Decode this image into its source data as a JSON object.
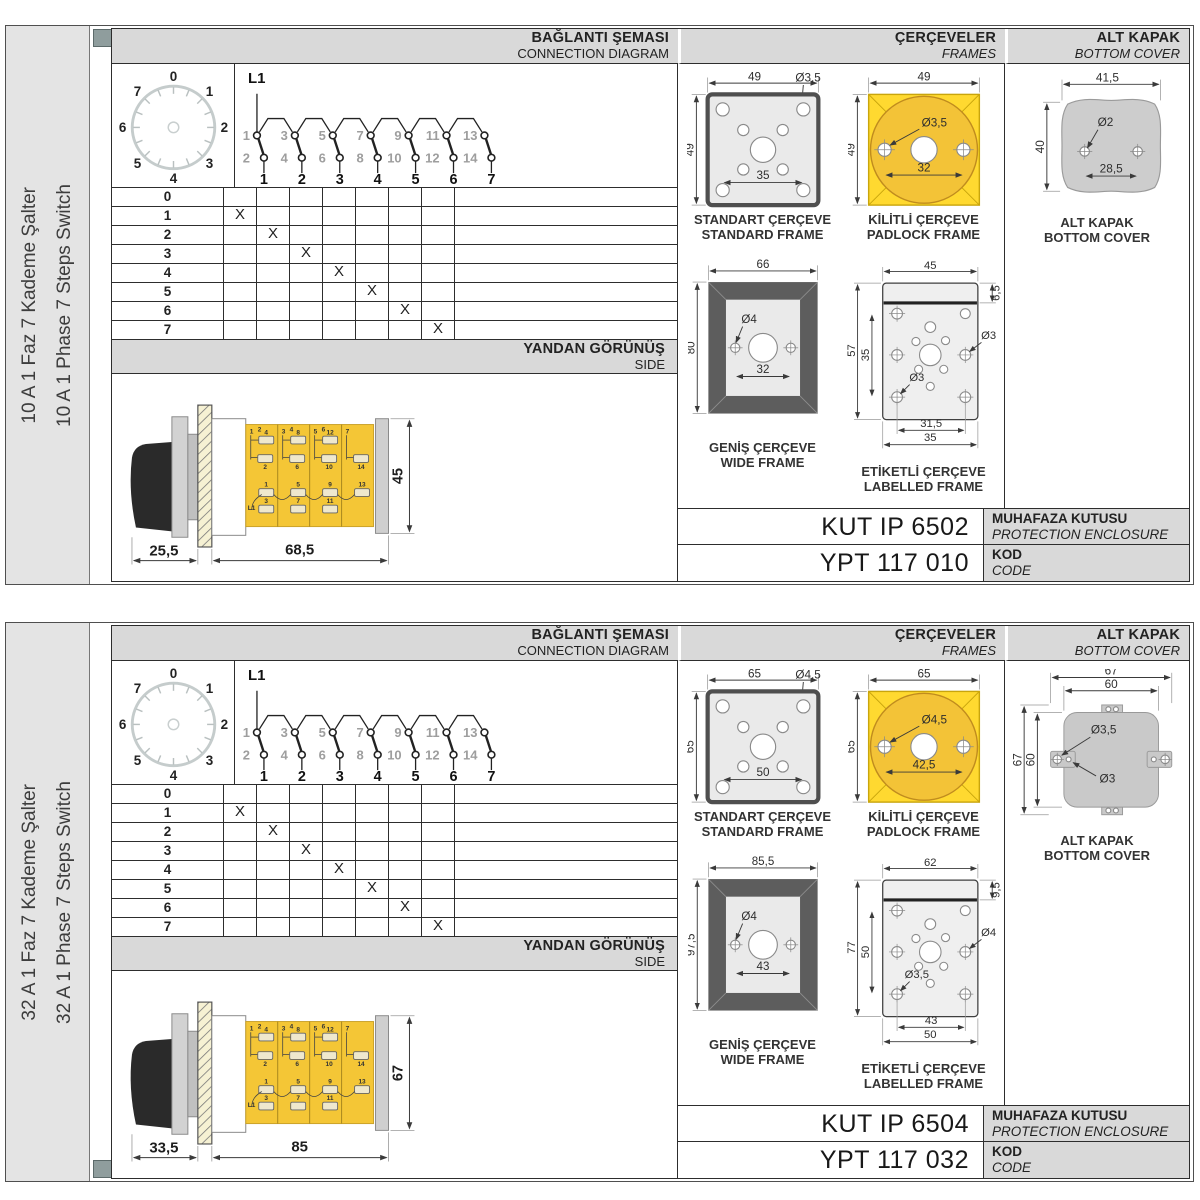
{
  "colors": {
    "header_bg": "#d9d9d9",
    "panel_border": "#4f4f4f",
    "sidebar_bg": "#e4e4e4",
    "marker": "#8f9d9d",
    "line_dark": "#2d2d2d",
    "yellow": "#ffd930",
    "yellow_deep": "#f3c337",
    "gray_fill": "#eaeaea",
    "bezel": "#5d5d5d",
    "cover_gray": "#cbcbcb"
  },
  "panels": [
    {
      "sidebar": {
        "title_tr": "10 A 1 Faz 7 Kademe Şalter",
        "title_en": "10 A 1 Phase 7 Steps Switch",
        "marker_top": true,
        "marker_bottom": null
      },
      "headers": {
        "connection_tr": "BAĞLANTI ŞEMASI",
        "connection_en": "CONNECTION DIAGRAM",
        "frames_tr": "ÇERÇEVELER",
        "frames_en": "FRAMES",
        "cover_tr": "ALT KAPAK",
        "cover_en": "BOTTOM COVER",
        "side_tr": "YANDAN GÖRÜNÜŞ",
        "side_en": "SIDE"
      },
      "dial": {
        "positions": [
          "0",
          "1",
          "2",
          "3",
          "4",
          "5",
          "6",
          "7"
        ]
      },
      "circuit": {
        "line_label": "L1",
        "switches": [
          {
            "top": "1",
            "bottom": "2",
            "column": "1"
          },
          {
            "top": "3",
            "bottom": "4",
            "column": "2"
          },
          {
            "top": "5",
            "bottom": "6",
            "column": "3"
          },
          {
            "top": "7",
            "bottom": "8",
            "column": "4"
          },
          {
            "top": "9",
            "bottom": "10",
            "column": "5"
          },
          {
            "top": "11",
            "bottom": "12",
            "column": "6"
          },
          {
            "top": "13",
            "bottom": "14",
            "column": "7"
          }
        ]
      },
      "step_table": {
        "rows": [
          {
            "label": "0",
            "marks": [
              "",
              "",
              "",
              "",
              "",
              "",
              ""
            ]
          },
          {
            "label": "1",
            "marks": [
              "X",
              "",
              "",
              "",
              "",
              "",
              ""
            ]
          },
          {
            "label": "2",
            "marks": [
              "",
              "X",
              "",
              "",
              "",
              "",
              ""
            ]
          },
          {
            "label": "3",
            "marks": [
              "",
              "",
              "X",
              "",
              "",
              "",
              ""
            ]
          },
          {
            "label": "4",
            "marks": [
              "",
              "",
              "",
              "X",
              "",
              "",
              ""
            ]
          },
          {
            "label": "5",
            "marks": [
              "",
              "",
              "",
              "",
              "X",
              "",
              ""
            ]
          },
          {
            "label": "6",
            "marks": [
              "",
              "",
              "",
              "",
              "",
              "X",
              ""
            ]
          },
          {
            "label": "7",
            "marks": [
              "",
              "",
              "",
              "",
              "",
              "",
              "X"
            ]
          }
        ]
      },
      "side_view": {
        "dim_front": "25,5",
        "dim_body": "68,5",
        "dim_height": "45",
        "line_label": "L1",
        "segments": [
          {
            "corner": "1",
            "corner2": "2",
            "t_upper": "4",
            "t_lower": "2",
            "t_mid": "1",
            "t_bot": "3"
          },
          {
            "corner": "3",
            "corner2": "4",
            "t_upper": "8",
            "t_lower": "6",
            "t_mid": "5",
            "t_bot": "7"
          },
          {
            "corner": "5",
            "corner2": "6",
            "t_upper": "12",
            "t_lower": "10",
            "t_mid": "9",
            "t_bot": "11"
          },
          {
            "corner": "7",
            "corner2": null,
            "t_upper": null,
            "t_lower": "14",
            "t_mid": "13",
            "t_bot": null
          }
        ]
      },
      "frames": {
        "standard": {
          "label_tr": "STANDART ÇERÇEVE",
          "label_en": "STANDARD FRAME",
          "width": "49",
          "height": "49",
          "hole": "Ø3,5",
          "inner": "35"
        },
        "padlock": {
          "label_tr": "KİLİTLİ ÇERÇEVE",
          "label_en": "PADLOCK FRAME",
          "width": "49",
          "height": "49",
          "hole": "Ø3,5",
          "inner": "32"
        },
        "wide": {
          "label_tr": "GENİŞ ÇERÇEVE",
          "label_en": "WIDE FRAME",
          "width": "66",
          "height": "80",
          "hole": "Ø4",
          "inner": "32"
        },
        "labelled": {
          "label_tr": "ETİKETLİ ÇERÇEVE",
          "label_en": "LABELLED FRAME",
          "width": "45",
          "strip": "6,5",
          "height": "57",
          "inner": "35",
          "hole_mid": "Ø3",
          "hole_corner": "Ø3",
          "dim_inner": "31,5",
          "dim_outer": "35"
        }
      },
      "cover": {
        "label_tr": "ALT KAPAK",
        "label_en": "BOTTOM COVER",
        "blob": {
          "width": "41,5",
          "height": "40",
          "hole": "Ø2",
          "spacing": "28,5"
        },
        "tabs": null
      },
      "codes": {
        "enclosure_code": "KUT IP 6502",
        "enclosure_label_tr": "MUHAFAZA KUTUSU",
        "enclosure_label_en": "PROTECTION ENCLOSURE",
        "code": "YPT 117 010",
        "code_label_tr": "KOD",
        "code_label_en": "CODE"
      }
    },
    {
      "sidebar": {
        "title_tr": "32 A 1 Faz 7 Kademe Şalter",
        "title_en": "32 A 1 Phase 7 Steps Switch",
        "marker_top": null,
        "marker_bottom": true
      },
      "headers": {
        "connection_tr": "BAĞLANTI ŞEMASI",
        "connection_en": "CONNECTION DIAGRAM",
        "frames_tr": "ÇERÇEVELER",
        "frames_en": "FRAMES",
        "cover_tr": "ALT KAPAK",
        "cover_en": "BOTTOM COVER",
        "side_tr": "YANDAN GÖRÜNÜŞ",
        "side_en": "SIDE"
      },
      "dial": {
        "positions": [
          "0",
          "1",
          "2",
          "3",
          "4",
          "5",
          "6",
          "7"
        ]
      },
      "circuit": {
        "line_label": "L1",
        "switches": [
          {
            "top": "1",
            "bottom": "2",
            "column": "1"
          },
          {
            "top": "3",
            "bottom": "4",
            "column": "2"
          },
          {
            "top": "5",
            "bottom": "6",
            "column": "3"
          },
          {
            "top": "7",
            "bottom": "8",
            "column": "4"
          },
          {
            "top": "9",
            "bottom": "10",
            "column": "5"
          },
          {
            "top": "11",
            "bottom": "12",
            "column": "6"
          },
          {
            "top": "13",
            "bottom": "14",
            "column": "7"
          }
        ]
      },
      "step_table": {
        "rows": [
          {
            "label": "0",
            "marks": [
              "",
              "",
              "",
              "",
              "",
              "",
              ""
            ]
          },
          {
            "label": "1",
            "marks": [
              "X",
              "",
              "",
              "",
              "",
              "",
              ""
            ]
          },
          {
            "label": "2",
            "marks": [
              "",
              "X",
              "",
              "",
              "",
              "",
              ""
            ]
          },
          {
            "label": "3",
            "marks": [
              "",
              "",
              "X",
              "",
              "",
              "",
              ""
            ]
          },
          {
            "label": "4",
            "marks": [
              "",
              "",
              "",
              "X",
              "",
              "",
              ""
            ]
          },
          {
            "label": "5",
            "marks": [
              "",
              "",
              "",
              "",
              "X",
              "",
              ""
            ]
          },
          {
            "label": "6",
            "marks": [
              "",
              "",
              "",
              "",
              "",
              "X",
              ""
            ]
          },
          {
            "label": "7",
            "marks": [
              "",
              "",
              "",
              "",
              "",
              "",
              "X"
            ]
          }
        ]
      },
      "side_view": {
        "dim_front": "33,5",
        "dim_body": "85",
        "dim_height": "67",
        "line_label": "L1",
        "segments": [
          {
            "corner": "1",
            "corner2": "2",
            "t_upper": "4",
            "t_lower": "2",
            "t_mid": "1",
            "t_bot": "3"
          },
          {
            "corner": "3",
            "corner2": "4",
            "t_upper": "8",
            "t_lower": "6",
            "t_mid": "5",
            "t_bot": "7"
          },
          {
            "corner": "5",
            "corner2": "6",
            "t_upper": "12",
            "t_lower": "10",
            "t_mid": "9",
            "t_bot": "11"
          },
          {
            "corner": "7",
            "corner2": null,
            "t_upper": null,
            "t_lower": "14",
            "t_mid": "13",
            "t_bot": null
          }
        ]
      },
      "frames": {
        "standard": {
          "label_tr": "STANDART ÇERÇEVE",
          "label_en": "STANDARD FRAME",
          "width": "65",
          "height": "65",
          "hole": "Ø4,5",
          "inner": "50"
        },
        "padlock": {
          "label_tr": "KİLİTLİ ÇERÇEVE",
          "label_en": "PADLOCK FRAME",
          "width": "65",
          "height": "65",
          "hole": "Ø4,5",
          "inner": "42,5"
        },
        "wide": {
          "label_tr": "GENİŞ ÇERÇEVE",
          "label_en": "WIDE FRAME",
          "width": "85,5",
          "height": "97,5",
          "hole": "Ø4",
          "inner": "43"
        },
        "labelled": {
          "label_tr": "ETİKETLİ ÇERÇEVE",
          "label_en": "LABELLED FRAME",
          "width": "62",
          "strip": "9,5",
          "height": "77",
          "inner": "50",
          "hole_mid": "Ø4",
          "hole_corner": "Ø3,5",
          "dim_inner": "43",
          "dim_outer": "50"
        }
      },
      "cover": {
        "label_tr": "ALT KAPAK",
        "label_en": "BOTTOM COVER",
        "blob": null,
        "tabs": {
          "width_outer": "67",
          "width_inner": "60",
          "height_outer": "67",
          "height_inner": "60",
          "hole_outer": "Ø3,5",
          "hole_inner": "Ø3"
        }
      },
      "codes": {
        "enclosure_code": "KUT IP 6504",
        "enclosure_label_tr": "MUHAFAZA KUTUSU",
        "enclosure_label_en": "PROTECTION ENCLOSURE",
        "code": "YPT 117 032",
        "code_label_tr": "KOD",
        "code_label_en": "CODE"
      }
    }
  ]
}
